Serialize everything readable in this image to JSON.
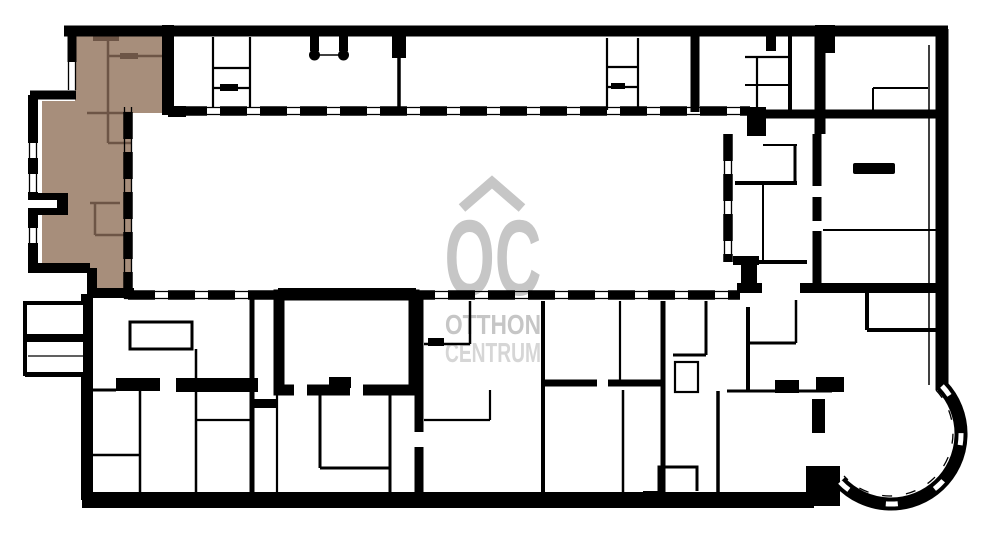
{
  "watermark": {
    "initials": "OC",
    "line1": "OTTHON",
    "line2": "CENTRUM"
  },
  "colors": {
    "background": "#ffffff",
    "walls": "#000000",
    "highlighted_unit_fill": "#a78e7b",
    "highlighted_unit_walls": "#6d5546",
    "watermark_gray": "#c6c6c6",
    "watermark_light_gray": "#d6d6d6"
  }
}
